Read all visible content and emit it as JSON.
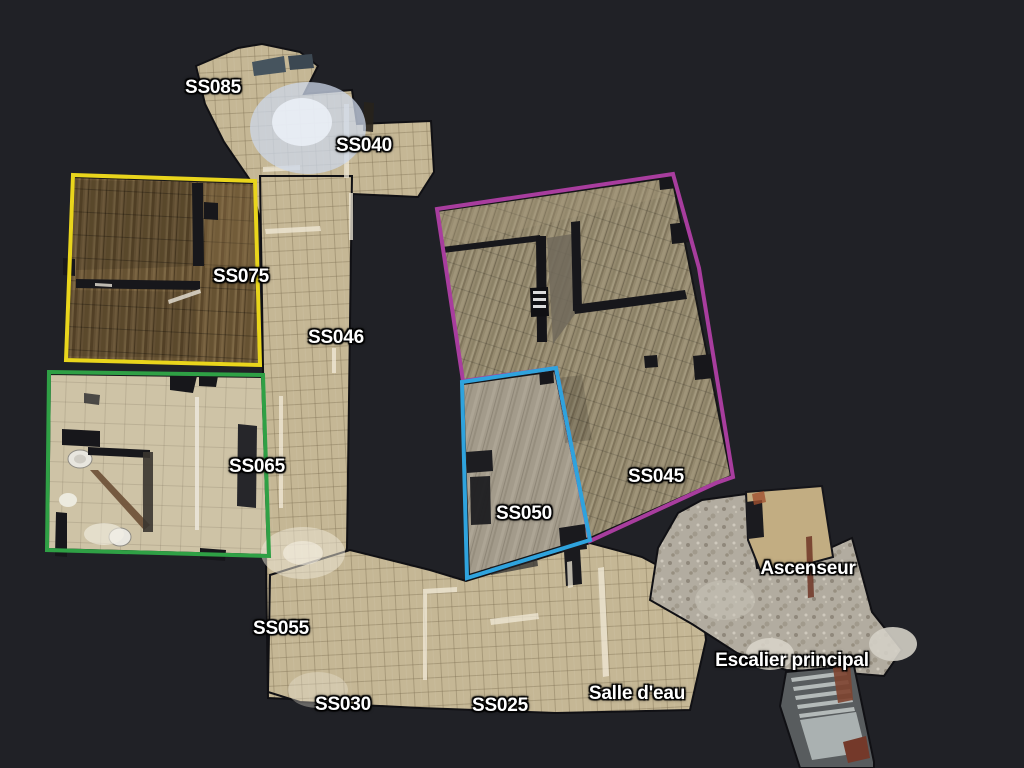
{
  "app": {
    "view_name": "floorplan-view",
    "background_color": "#202126"
  },
  "rooms": [
    {
      "id": "SS075",
      "outline_color": "#e9d51c"
    },
    {
      "id": "SS065",
      "outline_color": "#2fa045"
    },
    {
      "id": "SS050",
      "outline_color": "#2fa3dd"
    },
    {
      "id": "SS045",
      "outline_color": "#a83d9e"
    }
  ],
  "labels": [
    {
      "text": "SS085",
      "x": 213,
      "y": 88
    },
    {
      "text": "SS040",
      "x": 364,
      "y": 146
    },
    {
      "text": "SS075",
      "x": 241,
      "y": 277
    },
    {
      "text": "SS046",
      "x": 336,
      "y": 338
    },
    {
      "text": "SS065",
      "x": 257,
      "y": 467
    },
    {
      "text": "SS045",
      "x": 656,
      "y": 477
    },
    {
      "text": "SS050",
      "x": 524,
      "y": 514
    },
    {
      "text": "SS055",
      "x": 281,
      "y": 629
    },
    {
      "text": "Ascenseur",
      "x": 808,
      "y": 569
    },
    {
      "text": "Escalier principal",
      "x": 792,
      "y": 661
    },
    {
      "text": "SS030",
      "x": 343,
      "y": 705
    },
    {
      "text": "SS025",
      "x": 500,
      "y": 706
    },
    {
      "text": "Salle d'eau",
      "x": 637,
      "y": 694
    }
  ]
}
